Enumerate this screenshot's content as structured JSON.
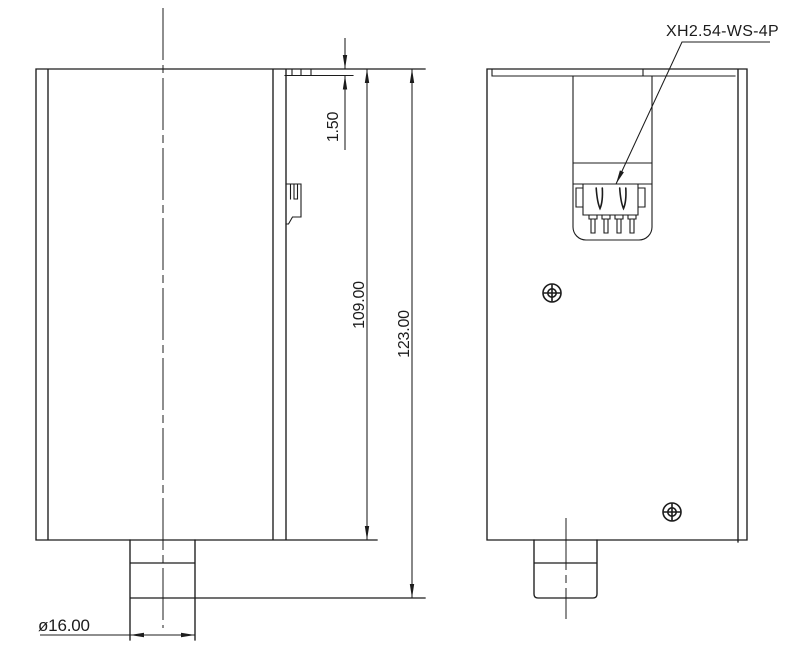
{
  "callouts": {
    "connector_label": "XH2.54-WS-4P"
  },
  "dimensions": {
    "lip_thickness": "1.50",
    "body_height": "109.00",
    "overall_height": "123.00",
    "boss_diameter": "ø16.00"
  },
  "colors": {
    "line": "#1c1c1c",
    "background": "#ffffff"
  }
}
